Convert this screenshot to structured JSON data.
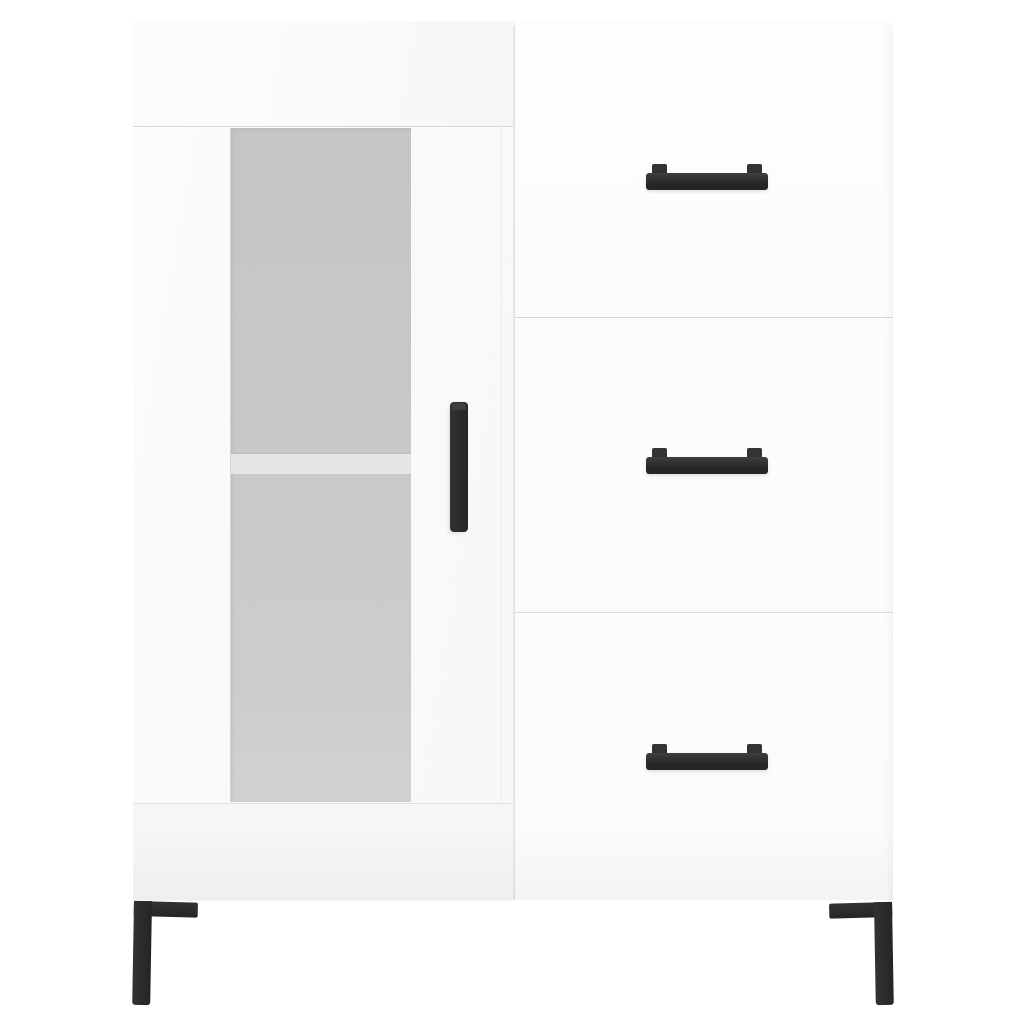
{
  "scene": {
    "description": "Product photo of a white high-gloss sideboard on a plain white background",
    "product_type": "sideboard",
    "finish": "high gloss white",
    "drawer_count": 3,
    "leg_count": 2
  },
  "labels": {
    "photo": "Product photo: white high-gloss sideboard",
    "cabinet": "White high-gloss sideboard cabinet",
    "top_panel": "Cabinet top panel",
    "door": "Display door with frosted glass insert",
    "glass": "Frosted glass panel",
    "shelf": "Interior shelf edge seen through glass",
    "door_handle": "Vertical black bar handle on door",
    "base_panel": "Cabinet base panel",
    "divider": "Seam between door section and drawer column",
    "drawer_section": "Drawer column",
    "drawers": [
      {
        "label": "Top drawer with black bar handle"
      },
      {
        "label": "Middle drawer with black bar handle"
      },
      {
        "label": "Bottom drawer with black bar handle"
      }
    ],
    "drawer_handle": "Horizontal black bar handle",
    "leg_left": "Black angled metal leg, left",
    "leg_right": "Black angled metal leg, right"
  },
  "colors": {
    "background": "#ffffff",
    "body": "#fbfcfc",
    "top_panel": "#f9fafa",
    "door_face": "#f7f8f9",
    "drawer_face": "#fcfdfd",
    "base_panel": "#f5f6f6",
    "seam": "#d9dbda",
    "divider": "#dcdedd",
    "glass_top": "#c4c6c6",
    "glass_bottom": "#d1d3d3",
    "shelf_band": "#e4e6e5",
    "shelf_edge": "#bfc1c0",
    "hardware_dark": "#242525",
    "hardware_mid": "#323333",
    "hardware_light": "#3e4040"
  }
}
